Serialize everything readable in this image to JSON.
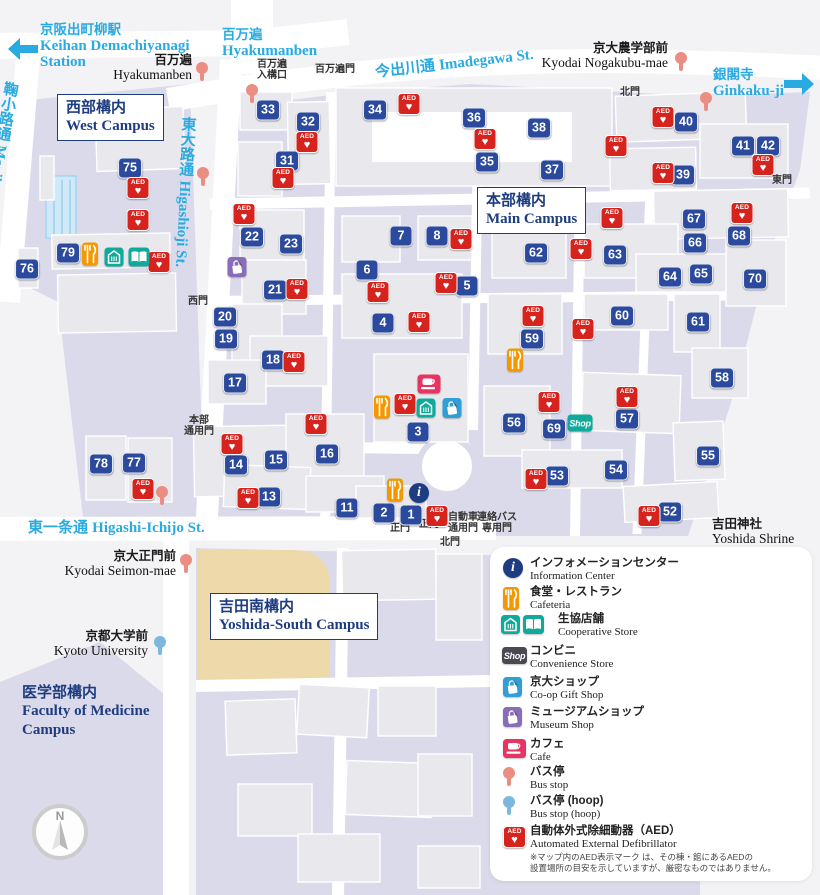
{
  "colors": {
    "cyan": "#29abe2",
    "navy": "#1e3c80",
    "marker_blue": "#2b4a9d",
    "aed_red": "#d7231d",
    "bus_salmon": "#ea8d82",
    "bus_hoop_blue": "#7cb8de",
    "orange": "#f39800",
    "teal": "#10a99c",
    "museum_purple": "#8a6db8",
    "gift_blue": "#2f9fd6",
    "cafe_pink": "#e73562",
    "shop_dark": "#4a4953",
    "torii_red": "#e60012",
    "lavender": "#dbdaea",
    "bg": "#f3f3f5",
    "building": "#e9e9ed",
    "field_tan": "#eed9ab",
    "pool_blue": "#cfe9f8"
  },
  "icon_text": {
    "shop": "Shop",
    "aed": "AED",
    "info": "i",
    "compass_n": "N"
  },
  "area_links": [
    {
      "id": "demachiyanagi",
      "jp": "京阪出町柳駅",
      "en_lines": [
        "Keihan Demachiyanagi",
        "Station"
      ],
      "x": 40,
      "y": 22,
      "arrow": "left",
      "ax": 8,
      "ay": 38
    },
    {
      "id": "hyakumanben",
      "jp": "百万遍",
      "en_lines": [
        "Hyakumanben"
      ],
      "x": 222,
      "y": 27
    },
    {
      "id": "ginkakuji",
      "jp": "銀閣寺",
      "en_lines": [
        "Ginkaku-ji"
      ],
      "x": 713,
      "y": 67,
      "arrow": "right",
      "ax": 784,
      "ay": 73
    }
  ],
  "streets": [
    {
      "id": "imadegawa",
      "jp": "今出川通",
      "en": "Imadegawa St.",
      "x": 374,
      "y": 61,
      "rot": -6.5,
      "vertical": false
    },
    {
      "id": "higashioji",
      "jp": "東大路通",
      "en": "Higashioji St.",
      "x": 178,
      "y": 116,
      "rot": 3,
      "vertical": true
    },
    {
      "id": "marikoji",
      "jp": "鞠小路通",
      "en": "Marikoji St.",
      "x": 1,
      "y": 80,
      "rot": 9,
      "vertical": true
    },
    {
      "id": "higashi-ichijo",
      "jp": "東一条通",
      "en": "Higashi-Ichijo St.",
      "x": 28,
      "y": 516,
      "rot": 0,
      "vertical": false
    }
  ],
  "campuses": [
    {
      "id": "west",
      "jp": "西部構内",
      "en_lines": [
        "West Campus"
      ],
      "x": 57,
      "y": 94,
      "boxed": true
    },
    {
      "id": "main",
      "jp": "本部構内",
      "en_lines": [
        "Main Campus"
      ],
      "x": 477,
      "y": 187,
      "boxed": true
    },
    {
      "id": "yoshida-south",
      "jp": "吉田南構内",
      "en_lines": [
        "Yoshida-South Campus"
      ],
      "x": 210,
      "y": 593,
      "boxed": true
    },
    {
      "id": "medicine",
      "jp": "医学部構内",
      "en_lines": [
        "Faculty of Medicine",
        "Campus"
      ],
      "x": 22,
      "y": 683,
      "boxed": false
    }
  ],
  "bus_stops": [
    {
      "jp": "百万遍",
      "en": "Hyakumanben",
      "right": 192,
      "y": 53,
      "pin": "bus",
      "px": 202,
      "py": 62
    },
    {
      "jp": "京大農学部前",
      "en": "Kyodai Nogakubu-mae",
      "right": 668,
      "y": 41,
      "pin": "bus",
      "px": 681,
      "py": 52
    },
    {
      "jp": "京大正門前",
      "en": "Kyodai Seimon-mae",
      "right": 176,
      "y": 549,
      "pin": "bus",
      "px": 186,
      "py": 554
    },
    {
      "jp": "京都大学前",
      "en": "Kyoto University",
      "right": 148,
      "y": 629,
      "pin": "hoop",
      "px": 160,
      "py": 636
    }
  ],
  "extra_pins": [
    {
      "t": "bus",
      "x": 252,
      "y": 84
    },
    {
      "t": "bus",
      "x": 203,
      "y": 167
    },
    {
      "t": "bus",
      "x": 706,
      "y": 92
    },
    {
      "t": "bus",
      "x": 162,
      "y": 486
    }
  ],
  "gates": [
    {
      "lines": [
        "百万遍",
        "入構口"
      ],
      "x": 272,
      "y": 60
    },
    {
      "lines": [
        "百万遍門"
      ],
      "x": 335,
      "y": 65
    },
    {
      "lines": [
        "北門"
      ],
      "x": 630,
      "y": 88
    },
    {
      "lines": [
        "東門"
      ],
      "x": 782,
      "y": 176
    },
    {
      "lines": [
        "西門"
      ],
      "x": 198,
      "y": 297
    },
    {
      "lines": [
        "本部",
        "通用門"
      ],
      "x": 199,
      "y": 416
    },
    {
      "lines": [
        "正門"
      ],
      "x": 400,
      "y": 524
    },
    {
      "lines": [
        "正門"
      ],
      "x": 429,
      "y": 520
    },
    {
      "lines": [
        "自動車",
        "通用門"
      ],
      "x": 463,
      "y": 513
    },
    {
      "lines": [
        "連絡バス",
        "専用門"
      ],
      "x": 497,
      "y": 513
    },
    {
      "lines": [
        "北門"
      ],
      "x": 450,
      "y": 538
    }
  ],
  "landmark": {
    "jp": "吉田神社",
    "en": "Yoshida Shrine",
    "x": 712,
    "y": 517,
    "torii_x": 758,
    "torii_y": 549
  },
  "building_markers": [
    [
      75,
      130,
      168
    ],
    [
      76,
      27,
      269
    ],
    [
      79,
      68,
      253
    ],
    [
      78,
      101,
      464
    ],
    [
      77,
      134,
      463
    ],
    [
      33,
      268,
      110
    ],
    [
      32,
      308,
      122
    ],
    [
      31,
      287,
      161
    ],
    [
      34,
      375,
      110
    ],
    [
      36,
      474,
      118
    ],
    [
      35,
      487,
      162
    ],
    [
      38,
      539,
      128
    ],
    [
      37,
      552,
      170
    ],
    [
      40,
      686,
      122
    ],
    [
      41,
      743,
      146
    ],
    [
      42,
      768,
      146
    ],
    [
      39,
      683,
      175
    ],
    [
      22,
      252,
      237
    ],
    [
      23,
      291,
      244
    ],
    [
      21,
      275,
      290
    ],
    [
      20,
      225,
      317
    ],
    [
      19,
      226,
      339
    ],
    [
      18,
      273,
      360
    ],
    [
      17,
      235,
      383
    ],
    [
      7,
      401,
      236
    ],
    [
      8,
      437,
      236
    ],
    [
      6,
      367,
      270
    ],
    [
      5,
      467,
      286
    ],
    [
      4,
      383,
      323
    ],
    [
      62,
      536,
      253
    ],
    [
      63,
      615,
      255
    ],
    [
      67,
      694,
      219
    ],
    [
      66,
      695,
      243
    ],
    [
      68,
      739,
      236
    ],
    [
      64,
      670,
      277
    ],
    [
      65,
      701,
      274
    ],
    [
      70,
      755,
      279
    ],
    [
      60,
      622,
      316
    ],
    [
      61,
      698,
      322
    ],
    [
      59,
      532,
      339
    ],
    [
      58,
      722,
      378
    ],
    [
      56,
      514,
      423
    ],
    [
      69,
      554,
      429
    ],
    [
      57,
      627,
      419
    ],
    [
      55,
      708,
      456
    ],
    [
      53,
      557,
      476
    ],
    [
      54,
      616,
      470
    ],
    [
      52,
      670,
      512
    ],
    [
      14,
      236,
      465
    ],
    [
      15,
      276,
      460
    ],
    [
      16,
      327,
      454
    ],
    [
      13,
      269,
      497
    ],
    [
      11,
      347,
      508
    ],
    [
      3,
      418,
      432
    ],
    [
      2,
      384,
      513
    ],
    [
      1,
      411,
      515
    ]
  ],
  "aed_positions": [
    [
      138,
      188
    ],
    [
      138,
      220
    ],
    [
      159,
      262
    ],
    [
      307,
      142
    ],
    [
      283,
      178
    ],
    [
      409,
      104
    ],
    [
      485,
      139
    ],
    [
      616,
      146
    ],
    [
      663,
      117
    ],
    [
      663,
      173
    ],
    [
      763,
      165
    ],
    [
      742,
      213
    ],
    [
      612,
      218
    ],
    [
      244,
      214
    ],
    [
      297,
      289
    ],
    [
      294,
      362
    ],
    [
      461,
      239
    ],
    [
      446,
      283
    ],
    [
      378,
      292
    ],
    [
      419,
      322
    ],
    [
      533,
      316
    ],
    [
      581,
      249
    ],
    [
      583,
      329
    ],
    [
      627,
      397
    ],
    [
      549,
      402
    ],
    [
      405,
      404
    ],
    [
      232,
      444
    ],
    [
      316,
      424
    ],
    [
      248,
      498
    ],
    [
      437,
      516
    ],
    [
      536,
      479
    ],
    [
      649,
      516
    ],
    [
      143,
      489
    ]
  ],
  "facility_icons": [
    {
      "t": "cafeteria",
      "x": 90,
      "y": 254
    },
    {
      "t": "coop_store",
      "x": 114,
      "y": 257
    },
    {
      "t": "coop_book",
      "x": 139,
      "y": 257
    },
    {
      "t": "museum",
      "x": 237,
      "y": 267
    },
    {
      "t": "cafe",
      "x": 429,
      "y": 384
    },
    {
      "t": "cafeteria",
      "x": 382,
      "y": 407
    },
    {
      "t": "coop_store",
      "x": 426,
      "y": 408
    },
    {
      "t": "giftshop",
      "x": 452,
      "y": 408
    },
    {
      "t": "cafeteria",
      "x": 515,
      "y": 360
    },
    {
      "t": "shop",
      "x": 580,
      "y": 423
    },
    {
      "t": "cafeteria",
      "x": 395,
      "y": 490
    },
    {
      "t": "info",
      "x": 419,
      "y": 493
    }
  ],
  "legend": {
    "items": [
      {
        "icon": "info",
        "jp": "インフォメーションセンター",
        "en": "Information Center",
        "y": 557
      },
      {
        "icon": "cafeteria",
        "jp": "食堂・レストラン",
        "en": "Cafeteria",
        "y": 586
      },
      {
        "icon": "coop",
        "jp": "生協店舗",
        "en": "Cooperative Store",
        "y": 613,
        "tx": 558
      },
      {
        "icon": "shop",
        "jp": "コンビニ",
        "en": "Convenience Store",
        "y": 645
      },
      {
        "icon": "giftshop",
        "jp": "京大ショップ",
        "en": "Co-op Gift Shop",
        "y": 676
      },
      {
        "icon": "museum",
        "jp": "ミュージアムショップ",
        "en": "Museum Shop",
        "y": 706
      },
      {
        "icon": "cafe",
        "jp": "カフェ",
        "en": "Cafe",
        "y": 738
      },
      {
        "icon": "bus",
        "jp": "バス停",
        "en": "Bus stop",
        "y": 766
      },
      {
        "icon": "hoop",
        "jp": "バス停 (hoop)",
        "en": "Bus stop (hoop)",
        "y": 795
      },
      {
        "icon": "aed",
        "jp": "自動体外式除細動器（AED）",
        "en": "Automated External Defibrillator",
        "y": 825
      }
    ],
    "note_lines": [
      "※マップ内のAED表示マーク は、その棟・館にあるAEDの",
      "設置場所の目安を示していますが、厳密なものではありません。"
    ]
  }
}
